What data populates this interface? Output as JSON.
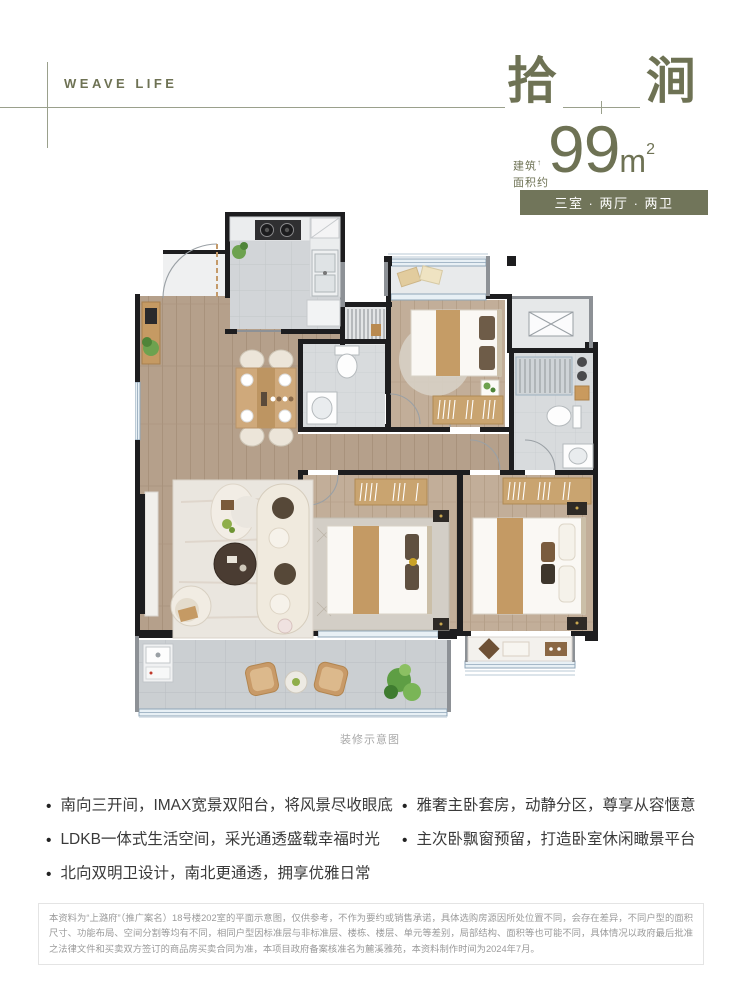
{
  "brand": {
    "logo_text": "WEAVE LIFE"
  },
  "title": {
    "char_left": "拾",
    "char_right": "涧"
  },
  "area": {
    "label_line1": "建筑",
    "label_note": "↑",
    "label_line2": "面积约",
    "value": "99",
    "unit": "m",
    "unit_sup": "2"
  },
  "badge": {
    "text": "三室 · 两厅 · 两卫",
    "bg": "#71755a"
  },
  "floorplan": {
    "caption": "装修示意图"
  },
  "features": {
    "left": [
      "南向三开间，IMAX宽景双阳台，将风景尽收眼底",
      "LDKB一体式生活空间，采光通透盛载幸福时光",
      "北向双明卫设计，南北更通透，拥享优雅日常"
    ],
    "right": [
      "雅奢主卧套房，动静分区，尊享从容惬意",
      "主次卧飘窗预留，打造卧室休闲瞰景平台"
    ]
  },
  "disclaimer": "本资料为“上潞府”（推广案名）18号楼202室的平面示意图，仅供参考，不作为要约或销售承诺，具体选购房源因所处位置不同，会存在差异，不同户型的面积尺寸、功能布局、空间分割等均有不同，相同户型因标准层与非标准层、楼栋、楼层、单元等差别，局部结构、面积等也可能不同，具体情况以政府最后批准之法律文件和买卖双方签订的商品房买卖合同为准，本项目政府备案核准名为麓溪雅苑，本资料制作时间为2024年7月。",
  "colors": {
    "accent": "#6e7254",
    "badge_bg": "#71755a",
    "wall": "#1d1d1f",
    "window": "#8fa6b8"
  }
}
